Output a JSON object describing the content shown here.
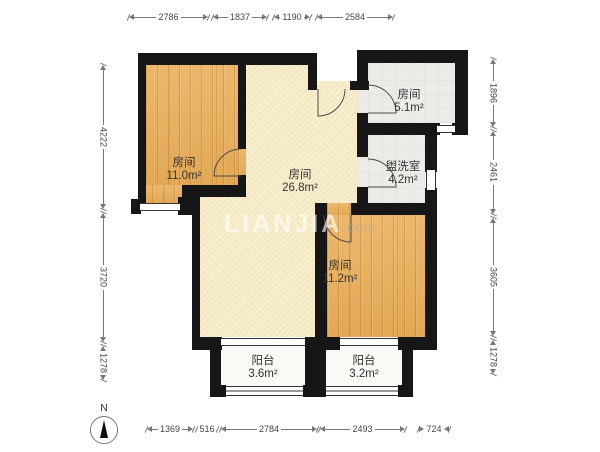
{
  "plan": {
    "watermark": {
      "brand": "LIANJIA",
      "suffix": ".com"
    },
    "compass": {
      "label": "N"
    },
    "rooms": [
      {
        "id": "bedroom-left",
        "name": "房间",
        "area": "11.0m²"
      },
      {
        "id": "hall-center",
        "name": "房间",
        "area": "26.8m²"
      },
      {
        "id": "room-topright",
        "name": "房间",
        "area": "5.1m²"
      },
      {
        "id": "washroom",
        "name": "盥洗室",
        "area": "4.2m²"
      },
      {
        "id": "bedroom-right",
        "name": "房间",
        "area": "11.2m²"
      },
      {
        "id": "balcony-left",
        "name": "阳台",
        "area": "3.6m²"
      },
      {
        "id": "balcony-right",
        "name": "阳台",
        "area": "3.2m²"
      }
    ],
    "dimensions": {
      "top": [
        "2786",
        "1837",
        "1190",
        "2584"
      ],
      "left": [
        "4222",
        "3720",
        "1278"
      ],
      "right": [
        "1896",
        "2461",
        "3605",
        "1278"
      ],
      "bottom": [
        "1369",
        "516",
        "2784",
        "2493",
        "724"
      ]
    },
    "colors": {
      "wall": "#161616",
      "wood_floor": "#e9b162",
      "hall_floor": "#f7edca",
      "tile_floor": "#ecebe7",
      "balcony_floor": "#faf9f5",
      "dimension_line": "#787878"
    }
  }
}
